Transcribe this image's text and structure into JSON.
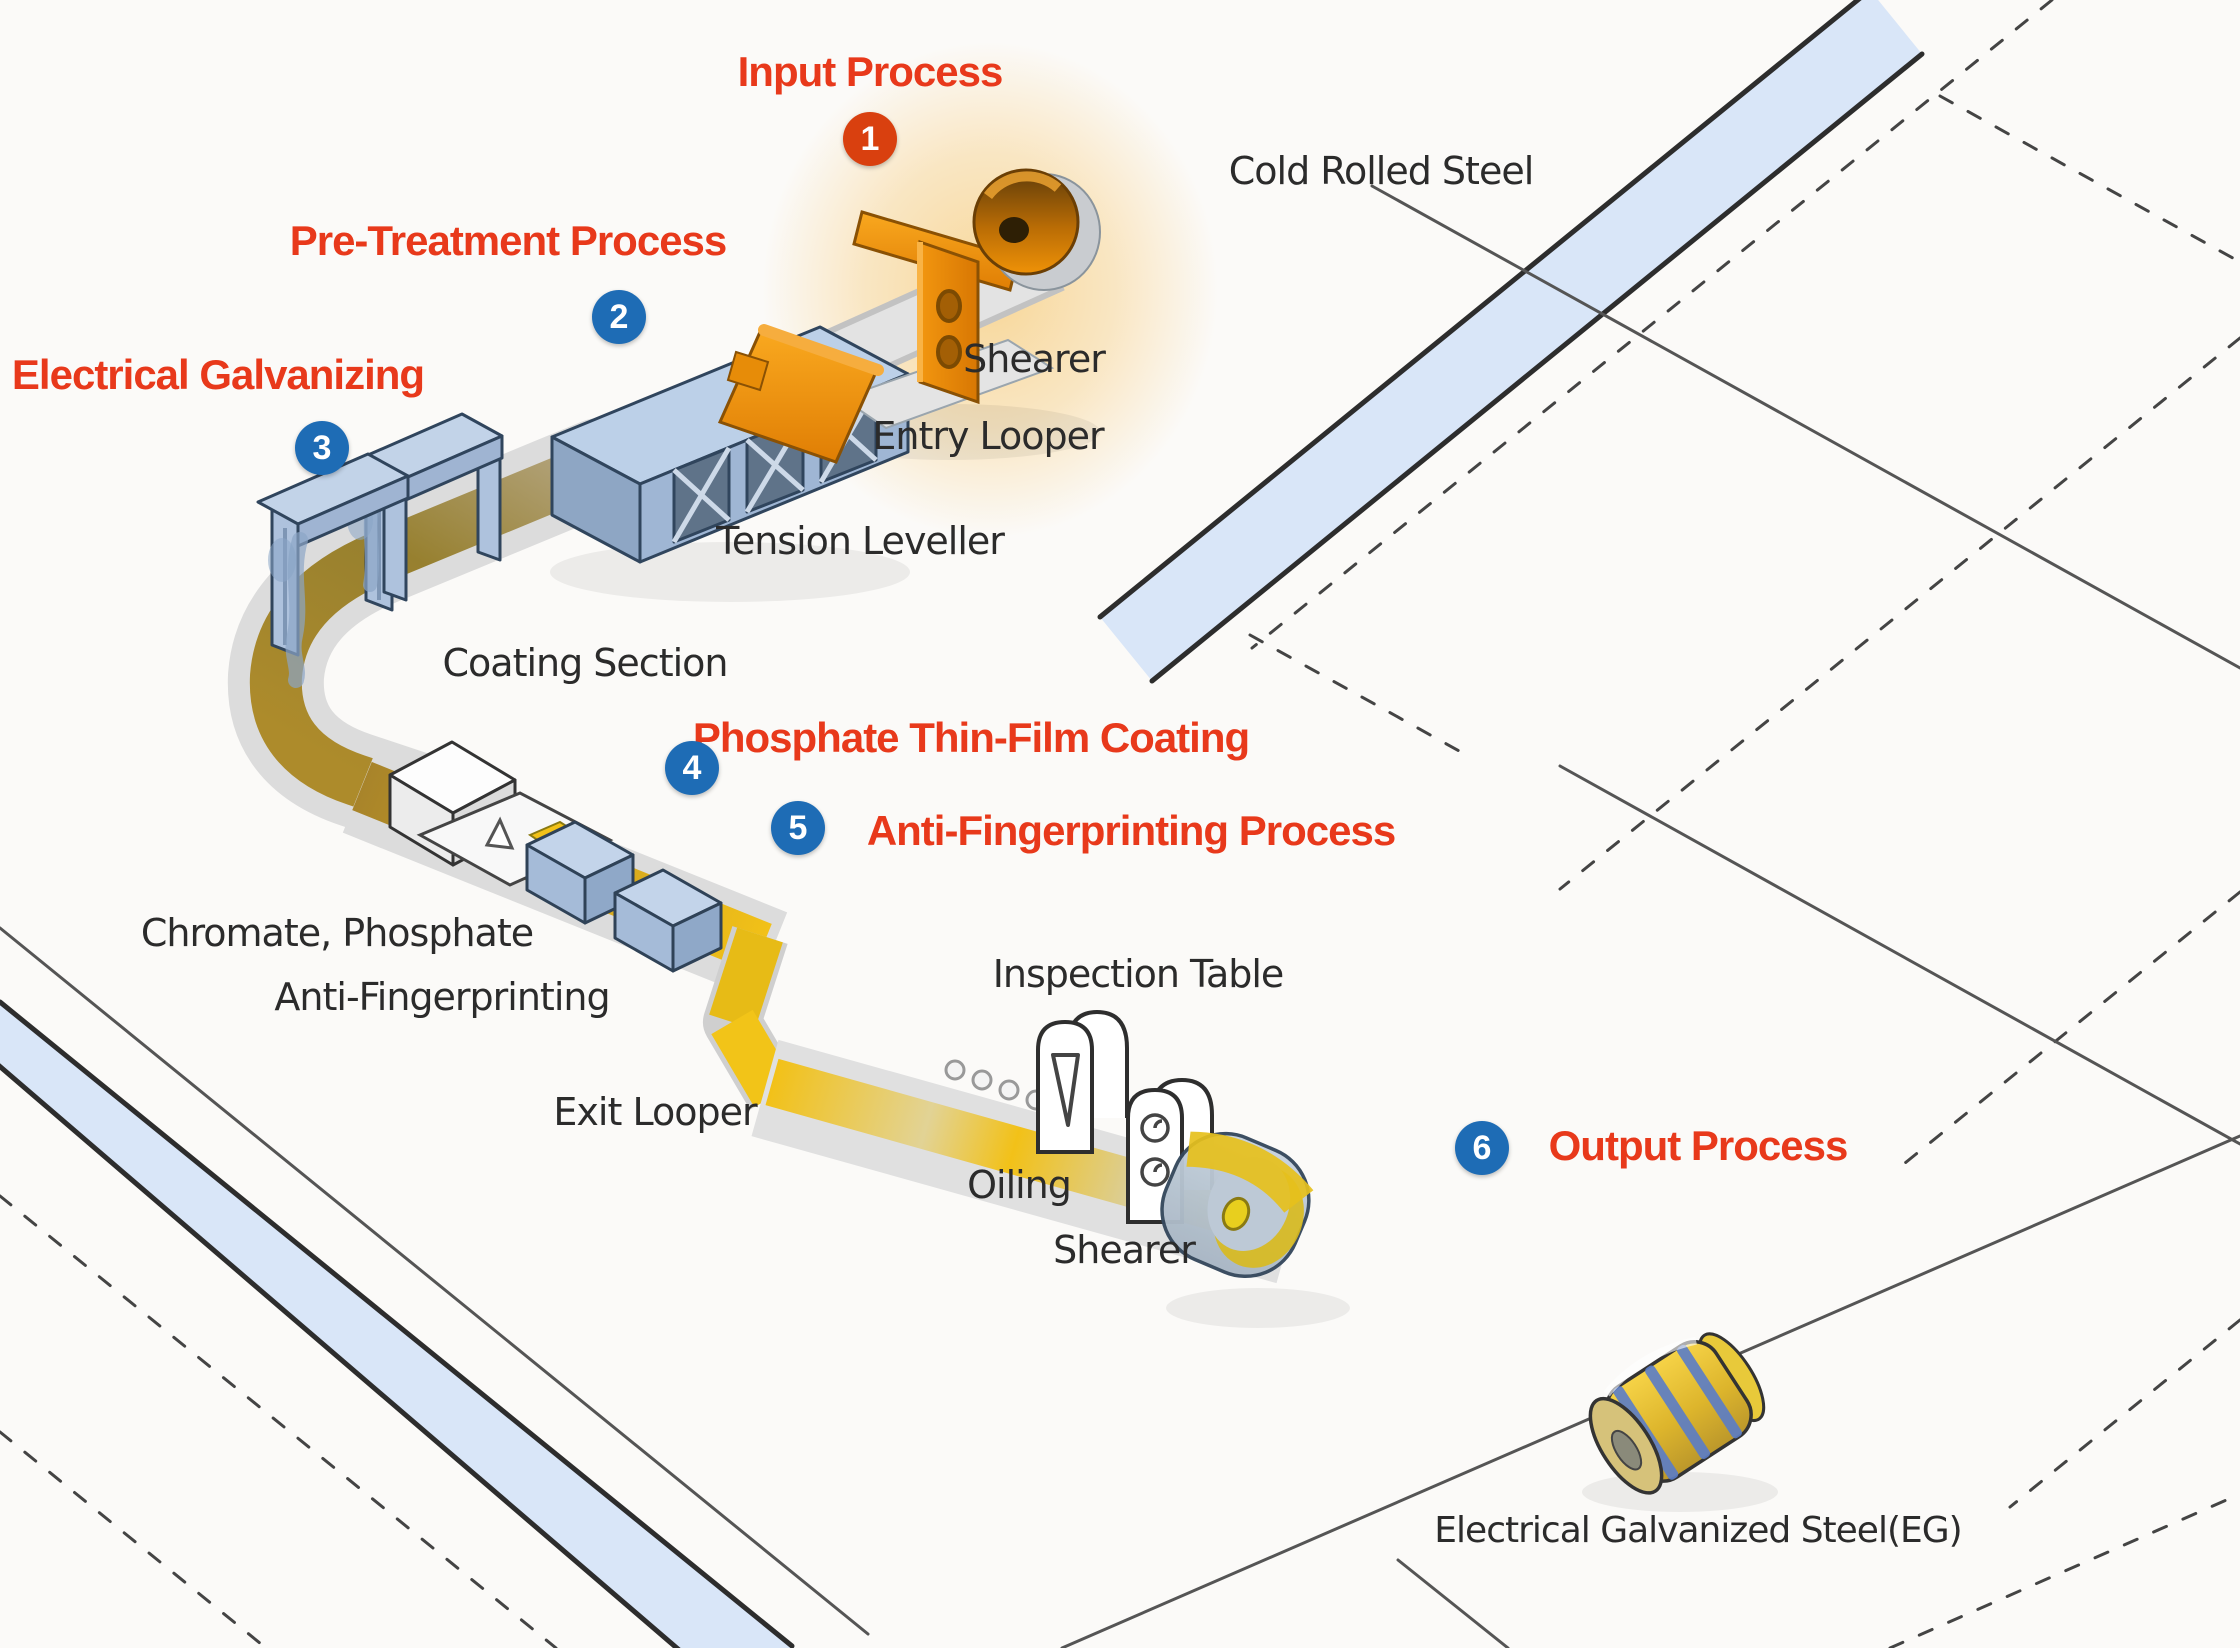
{
  "process_steps": [
    {
      "number": "1",
      "label": "Input Process",
      "badge_color": "#d9400f"
    },
    {
      "number": "2",
      "label": "Pre-Treatment Process",
      "badge_color": "#1e6cb5"
    },
    {
      "number": "3",
      "label": "Electrical Galvanizing",
      "badge_color": "#1e6cb5"
    },
    {
      "number": "4",
      "label": "Phosphate Thin-Film Coating",
      "badge_color": "#1e6cb5"
    },
    {
      "number": "5",
      "label": "Anti-Fingerprinting Process",
      "badge_color": "#1e6cb5"
    },
    {
      "number": "6",
      "label": "Output Process",
      "badge_color": "#1e6cb5"
    }
  ],
  "equipment": {
    "cold_rolled_steel": "Cold Rolled Steel",
    "shearer_entry": "Shearer",
    "entry_looper": "Entry Looper",
    "tension_leveller": "Tension Leveller",
    "coating_section": "Coating Section",
    "chromate_phosphate": "Chromate, Phosphate",
    "anti_fingerprinting": "Anti-Fingerprinting",
    "exit_looper": "Exit Looper",
    "inspection_table": "Inspection Table",
    "oiling": "Oiling",
    "shearer_exit": "Shearer",
    "eg_output": "Electrical Galvanized Steel(EG)"
  },
  "colors": {
    "step_label_red": "#e8391b",
    "badge_blue": "#1e6cb5",
    "badge_red": "#d9400f",
    "equipment_label_black": "#2b2b2b",
    "road_blue": "#d9e6f8",
    "machine_blue": "#b6c8e0",
    "machine_orange": "#f29312",
    "strip_gray": "#d9d9d9",
    "strip_olive": "#a8842c",
    "strip_yellow": "#f2c118"
  }
}
